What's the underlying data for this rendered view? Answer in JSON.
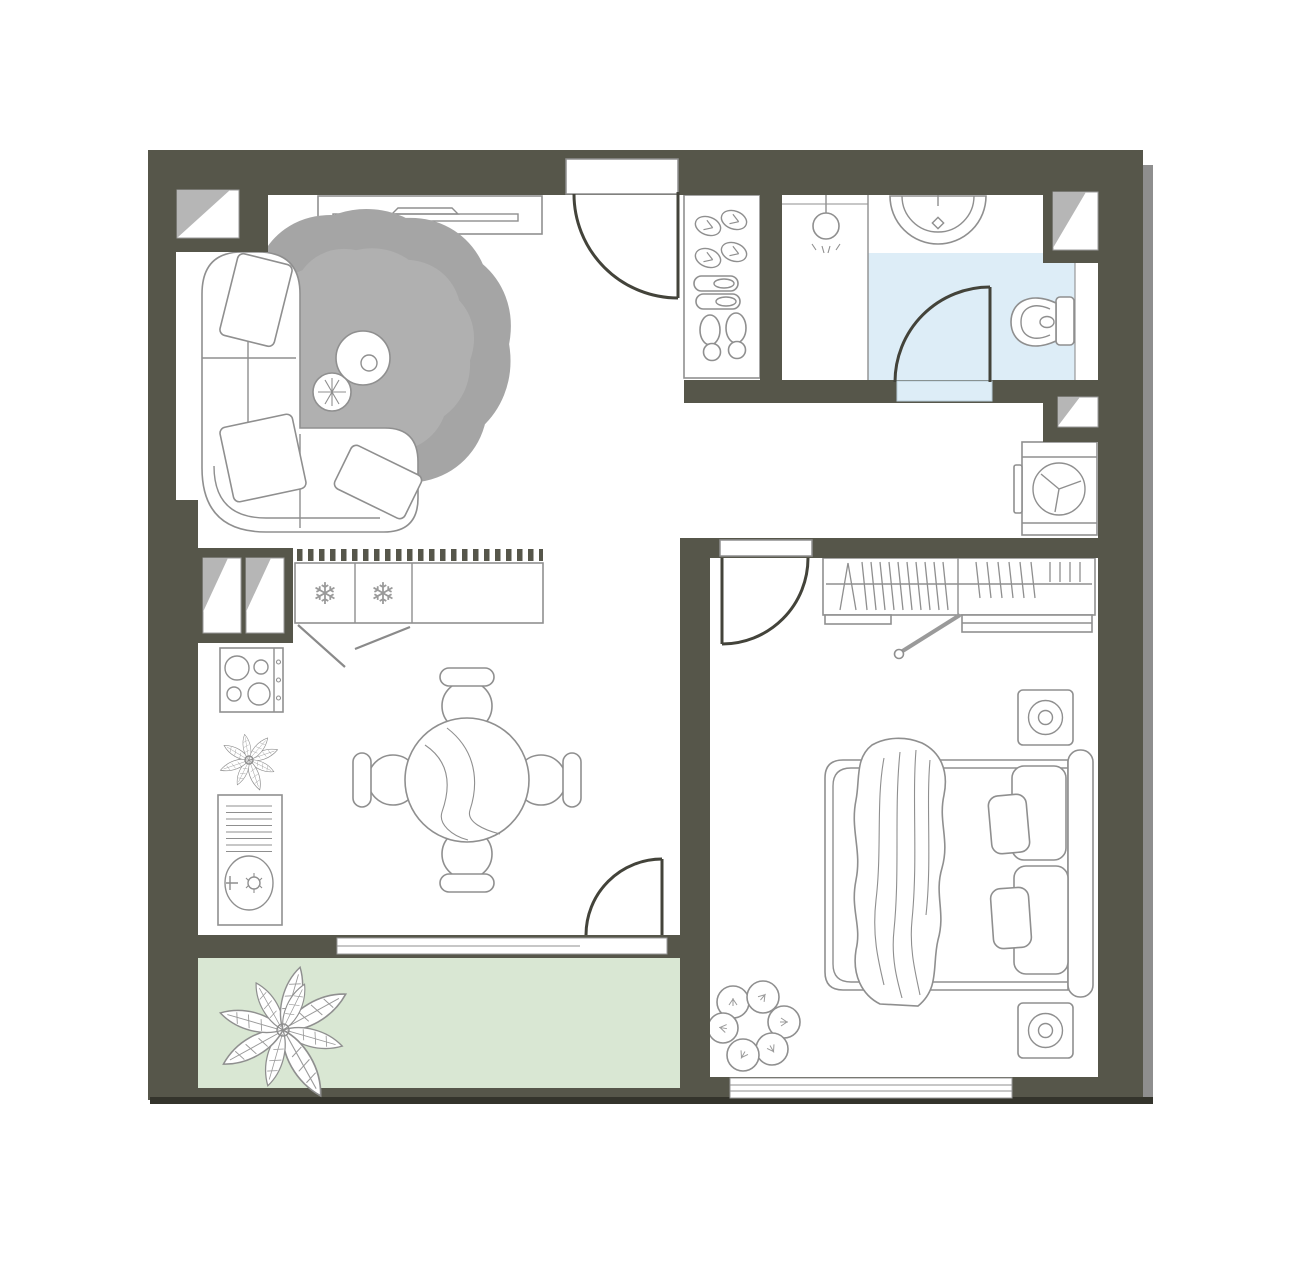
{
  "palette": {
    "wall": "#56564a",
    "floor": "#ffffff",
    "bathroom_floor": "#ddedf7",
    "balcony_floor": "#d9e7d3",
    "window_shade": "#b6b6b6",
    "furniture_line": "#8f8f8f",
    "door_line": "#43433a",
    "outer_highlight": "#8e8e8e",
    "outer_shadow": "#34342c"
  },
  "icons": {
    "snowflake": "❄"
  },
  "plan": {
    "type": "apartment-floor-plan",
    "rooms": [
      {
        "id": "living-room",
        "floor": "floor",
        "furniture": [
          "tv-console",
          "corner-sofa",
          "pillow",
          "pillow",
          "pillow",
          "rug",
          "coffee-table",
          "side-table"
        ]
      },
      {
        "id": "entry-hall",
        "floor": "floor",
        "furniture": [
          "entry-door",
          "shoe-rack"
        ]
      },
      {
        "id": "bathroom",
        "floor": "bathroom_floor",
        "furniture": [
          "shower",
          "wash-basin",
          "toilet",
          "door"
        ]
      },
      {
        "id": "utility-niche",
        "floor": "floor",
        "furniture": [
          "washing-machine"
        ]
      },
      {
        "id": "kitchen-dining",
        "floor": "floor",
        "furniture": [
          "freezer",
          "fridge",
          "counter",
          "stove",
          "kitchen-sink",
          "plant",
          "dining-table",
          "chair",
          "chair",
          "chair",
          "chair",
          "balcony-door"
        ]
      },
      {
        "id": "bedroom",
        "floor": "floor",
        "furniture": [
          "door",
          "wardrobe",
          "bed",
          "blanket",
          "pillow",
          "pillow",
          "pillow",
          "pillow",
          "nightstand",
          "nightstand",
          "plant"
        ]
      },
      {
        "id": "balcony",
        "floor": "balcony_floor",
        "furniture": [
          "plant"
        ]
      }
    ],
    "windows": [
      "living-room-top",
      "kitchen-left-bay",
      "bathroom-right",
      "utility-right",
      "balcony-band",
      "bedroom-bottom"
    ],
    "doors": [
      "entry",
      "bathroom",
      "bedroom",
      "balcony"
    ]
  }
}
